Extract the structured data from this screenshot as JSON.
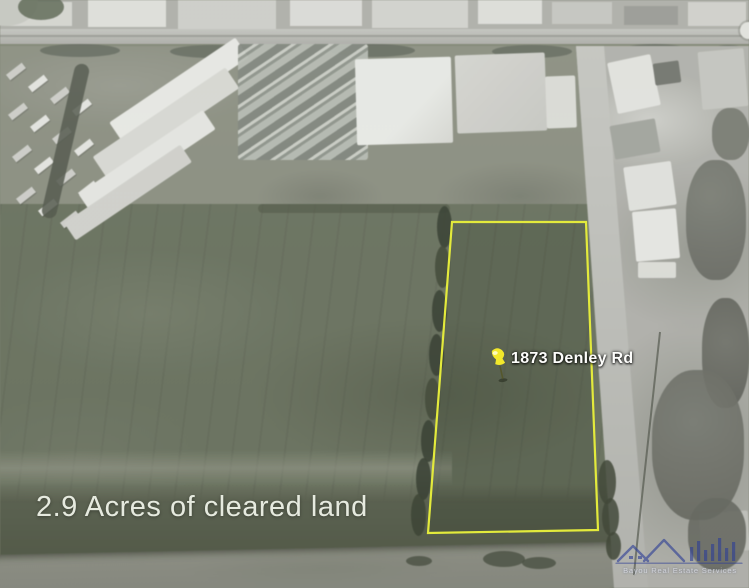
{
  "caption": {
    "text": "2.9 Acres of cleared land"
  },
  "parcel": {
    "address_label": "1873 Denley Rd",
    "points": "452,222 586,222 598,530 428,533",
    "outline_color": "#e3ea3c",
    "pin_color": "#f2e82b"
  },
  "watermark": {
    "text": "Bayou Real Estate Services",
    "color": "#2e3f96"
  }
}
